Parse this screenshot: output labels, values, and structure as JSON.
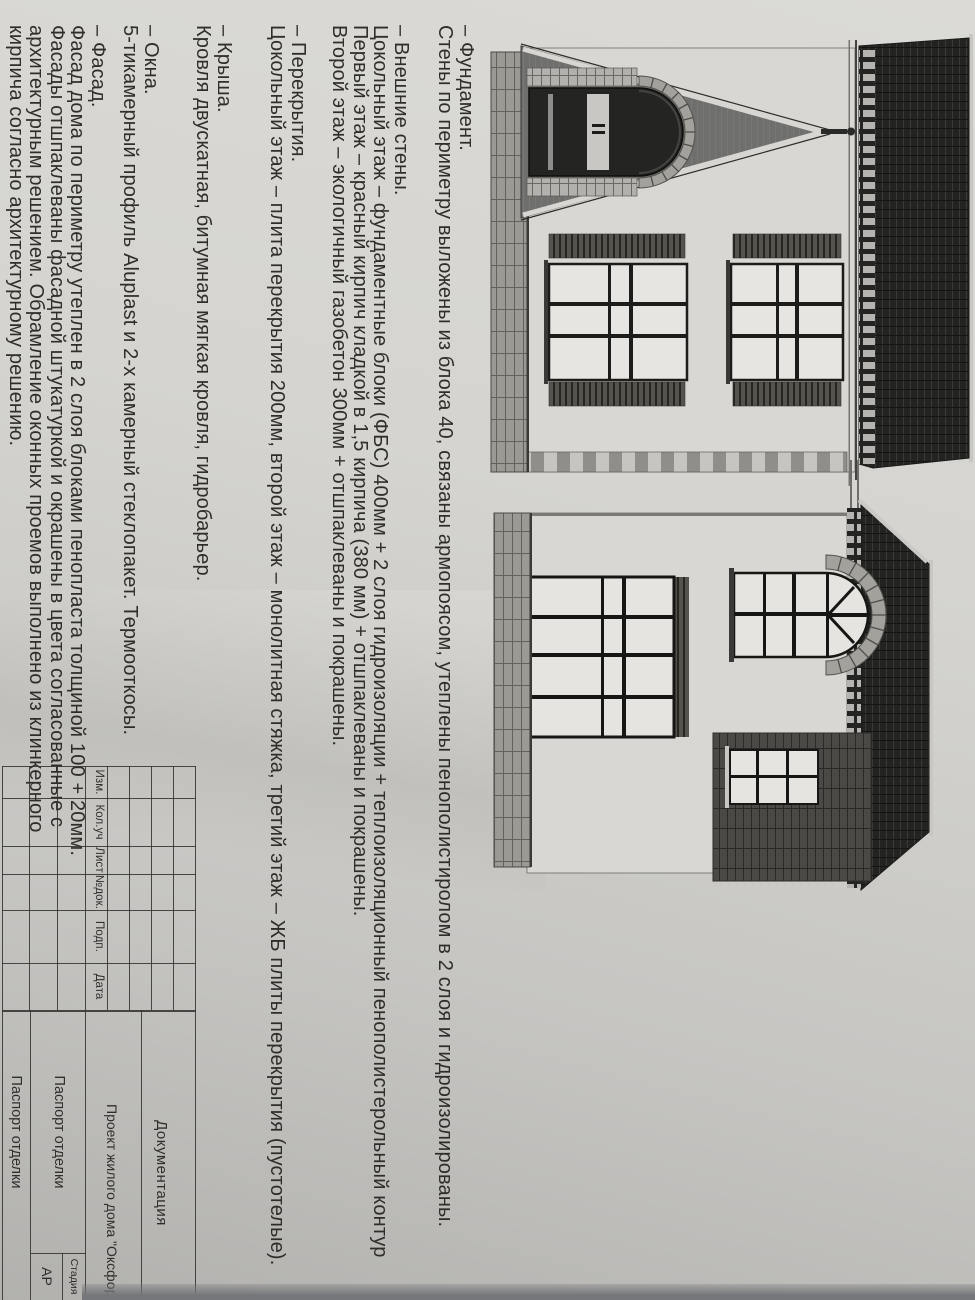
{
  "colors": {
    "paper": "#d5d4d0",
    "paper_shadow": "#b2b1ae",
    "ink": "#262522",
    "backdrop_strip": "#75777a",
    "roof_dark": "#232321",
    "gable_gray": "#6f6f6d"
  },
  "specs": {
    "sections": [
      {
        "heading": "– Фундамент.",
        "lines": [
          "Стены по периметру выложены из блока 40, связаны армопоясом, утеплены пенополистиролом в 2 слоя и гидроизолированы."
        ]
      },
      {
        "heading": "– Внешние стены.",
        "lines": [
          "Цокольный этаж – фундаментные блоки (ФБС) 400мм + 2 слоя гидроизоляции + теплоизоляционный пенополистерольный контур",
          "Первый этаж – красный кирпич кладкой в 1,5 кирпича (380 мм) + отшпаклеваны и покрашены.",
          "Второй этаж – экологичный газобетон 300мм +  отшпаклеваны и покрашены."
        ]
      },
      {
        "heading": "– Перекрытия.",
        "lines": [
          "Цокольный этаж  – плита перекрытия 200мм, второй этаж – монолитная стяжка, третий этаж – ЖБ плиты перекрытия (пустотелые)."
        ]
      },
      {
        "heading": "– Крыша.",
        "lines": [
          "Кровля двускатная, битумная мягкая кровля, гидробарьер."
        ]
      },
      {
        "heading": "– Окна.",
        "lines": [
          "5-тикамерный профиль Aluplast и 2-х камерный стеклопакет. Термооткосы."
        ]
      },
      {
        "heading": "– Фасад.",
        "lines": [
          "Фасад дома по периметру утеплен в 2 слоя блоками пенопласта толщиной 100 + 20мм.",
          "Фасады отшпаклеваны фасадной штукатуркой и окрашены в цвета согласованные с",
          "архитектурным решением. Обрамление оконных проемов выполнено из клинкерного",
          "кирпича согласно архитектурному решению."
        ]
      }
    ]
  },
  "titleblock": {
    "rev_headers": [
      "Изм.",
      "Кол.уч",
      "Лист",
      "№док.",
      "Подп.",
      "Дата"
    ],
    "doc_type": "Документация",
    "project_name": "Проект жилого дома \"Оксфорд\" в г.Ха",
    "sheet_name_1": "Паспорт отделки",
    "sheet_name_2": "Паспорт отделки",
    "stage_label": "Стадия",
    "stage_value": "АР"
  }
}
